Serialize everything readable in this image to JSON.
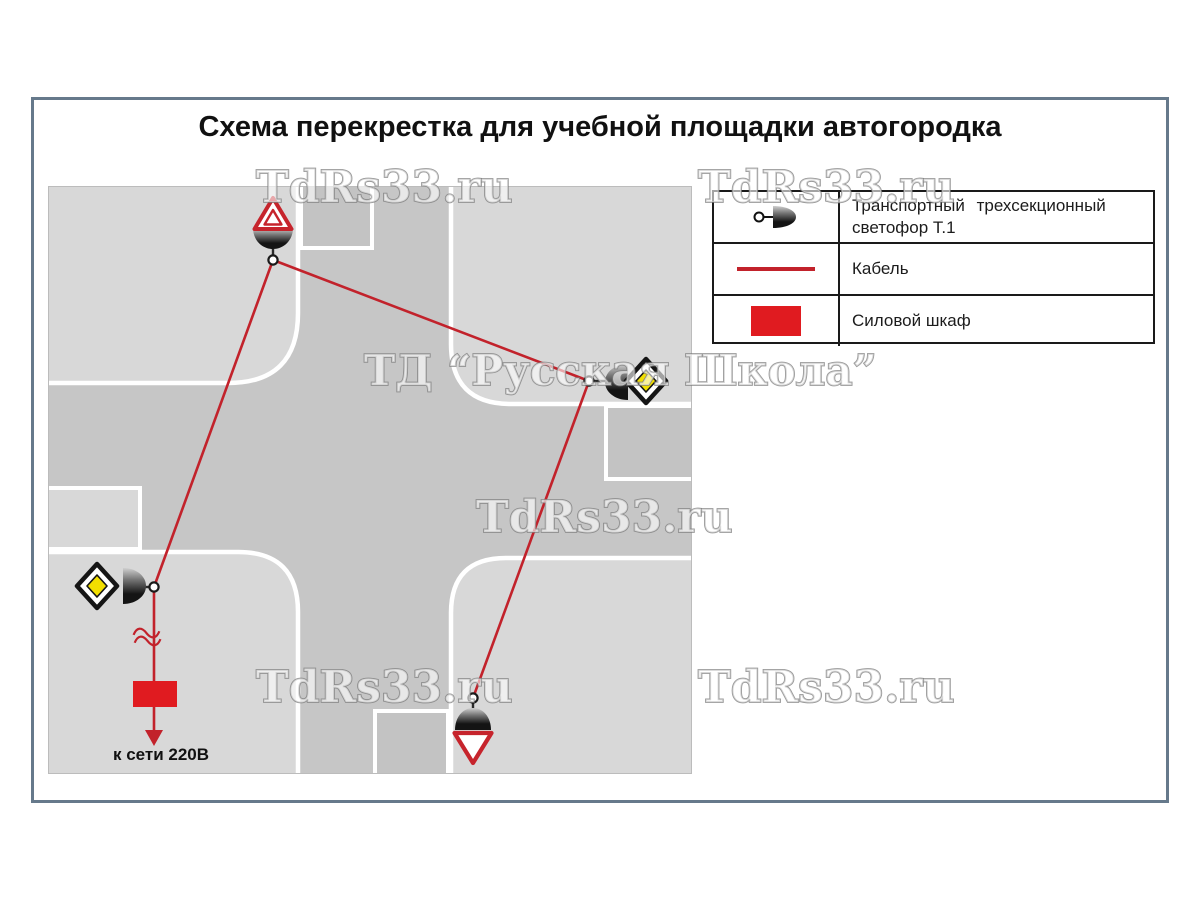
{
  "title": "Схема перекрестка для учебной площадки автогородка",
  "legend": {
    "rows": [
      {
        "icon": "traffic-light-icon",
        "label": "Транспортный трехсекционный",
        "label2": "светофор Т.1"
      },
      {
        "icon": "cable-line-icon",
        "label": "Кабель"
      },
      {
        "icon": "power-cabinet-icon",
        "label": "Силовой шкаф"
      }
    ]
  },
  "diagram": {
    "power_label": "к сети 220В"
  },
  "watermarks": {
    "site": "TdRs33.ru",
    "company": "ТД “Русская Школа”"
  },
  "icons": {
    "traffic_light": "half-dome-traffic-light-icon",
    "cable": "red-cable-line-icon",
    "power_cabinet": "red-rectangle-icon",
    "priority_road_sign": "yellow-diamond-sign-icon",
    "yield_sign": "inverted-red-triangle-sign-icon",
    "warning_sign": "red-triangle-sign-icon",
    "junction_node": "cable-node-icon"
  },
  "colors": {
    "road": "#c6c6c6",
    "block": "#d8d8d8",
    "road_patch": "#c3c3c3",
    "cable": "#c2222b",
    "cabinet_red": "#e01b20",
    "sign_red": "#c6242c",
    "sign_yellow": "#f2df00",
    "frame": "#66798b",
    "legend_border": "#1a1a1a",
    "text": "#111111",
    "watermark_fill": "rgba(255,255,255,0.6)",
    "watermark_stroke": "#8f8f8f"
  }
}
